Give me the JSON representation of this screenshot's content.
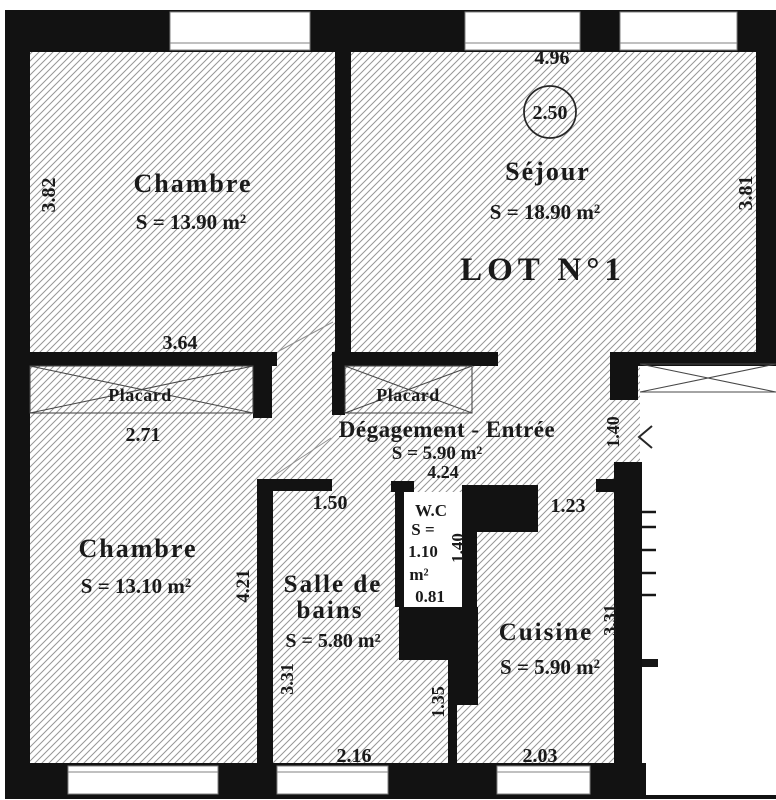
{
  "plan": {
    "lot_label": "LOT N°1",
    "rooms": {
      "chambre_top": {
        "name": "Chambre",
        "area": "S = 13.90 m²",
        "dim_bottom": "3.64",
        "dim_left": "3.82"
      },
      "sejour": {
        "name": "Séjour",
        "area": "S = 18.90 m²",
        "dim_top": "4.96",
        "ceiling_height": "2.50",
        "dim_right": "3.81"
      },
      "degagement": {
        "name": "Dégagement - Entrée",
        "area": "S = 5.90 m²",
        "dim_width": "4.24",
        "entry_door_dim": "1.40"
      },
      "wc": {
        "name": "W.C",
        "area_prefix": "S =",
        "area_value": "1.10",
        "area_unit": "m²",
        "dim_width": "0.81",
        "dim_depth": "1.40"
      },
      "chambre_bottom": {
        "name": "Chambre",
        "area": "S = 13.10 m²",
        "dim_height": "4.21"
      },
      "salle_de_bains": {
        "name_line1": "Salle de",
        "name_line2": "bains",
        "area": "S = 5.80 m²",
        "dim_top": "1.50",
        "dim_left": "3.31",
        "dim_bottom": "2.16"
      },
      "cuisine": {
        "name": "Cuisine",
        "area": "S = 5.90 m²",
        "dim_top": "1.23",
        "dim_left": "1.35",
        "dim_right": "3.31",
        "dim_bottom": "2.03"
      }
    },
    "closets": {
      "left": {
        "label": "Placard",
        "dim": "2.71"
      },
      "middle": {
        "label": "Placard"
      }
    },
    "colors": {
      "wall": "#161616",
      "hatch_line": "#979797",
      "ink": "#1e1e1e"
    }
  }
}
